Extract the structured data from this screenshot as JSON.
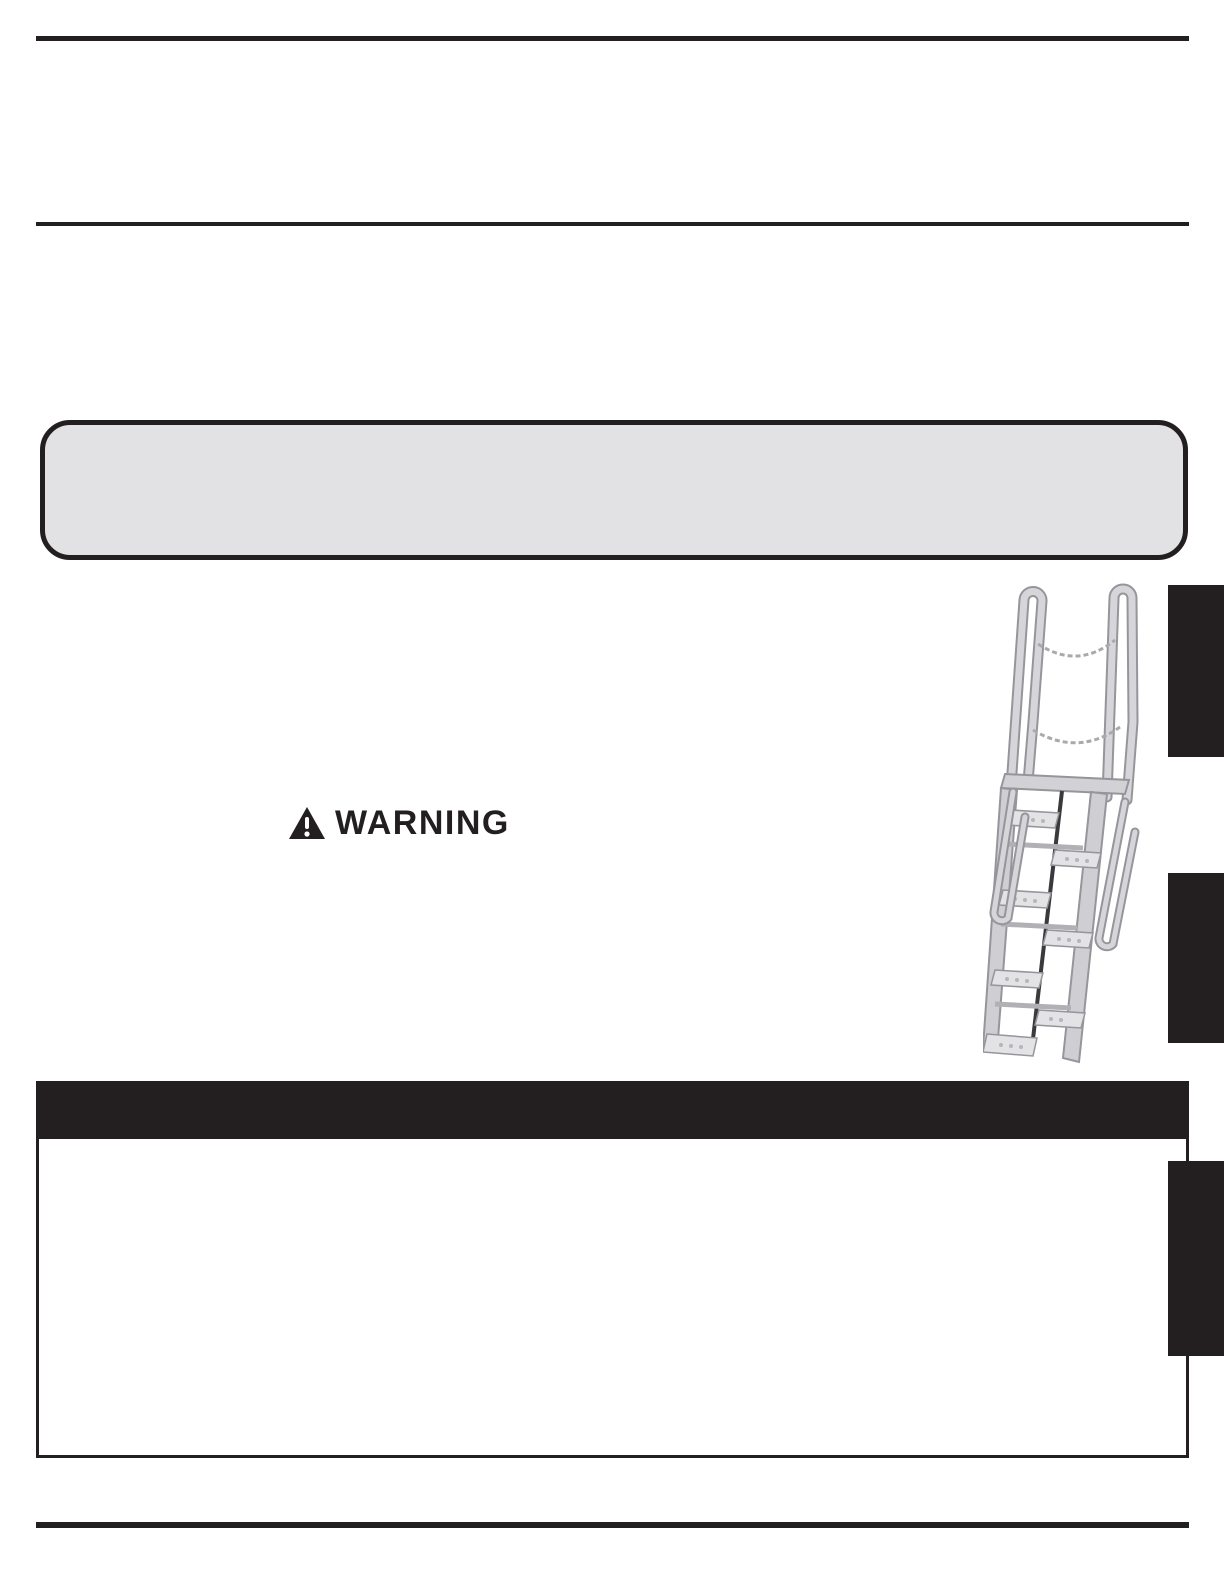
{
  "warning": {
    "label": "WARNING",
    "icon": "warning-triangle-icon"
  },
  "callout": {
    "text": ""
  },
  "section_bar": {
    "text": ""
  },
  "side_tabs": {
    "count": 3
  },
  "illustration": {
    "name": "alternating-tread-ladder",
    "features": "two walk-through rails, two safety chains, alternating perforated treads, side handrails"
  },
  "colors": {
    "ink": "#231f20",
    "callout_fill": "#e2e2e4",
    "page_bg": "#ffffff",
    "ladder_light": "#dfdfe2",
    "ladder_mid": "#c3c3c8",
    "ladder_outline": "#95959b",
    "chain": "#a9a9ae"
  }
}
